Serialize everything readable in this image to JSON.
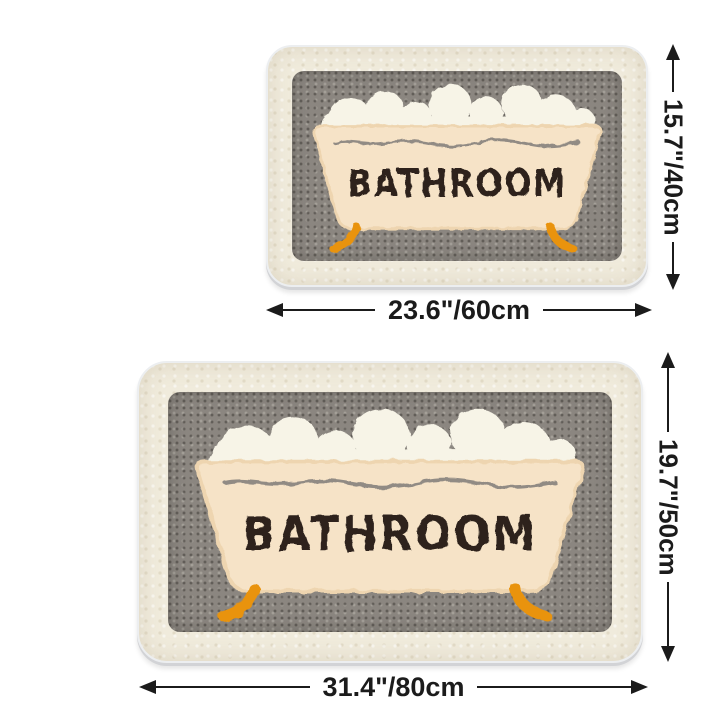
{
  "page": {
    "background_color": "#ffffff",
    "description_text": ""
  },
  "rug_design": {
    "text": "BATHROOM",
    "colors": {
      "border_fluff": "#f0ebdc",
      "inner_panel_gray": "#8b8680",
      "tub_body": "#f6e3c7",
      "tub_edge": "#eed5b0",
      "foam": "#f7f4e7",
      "lettering": "#2d241d",
      "rim_line": "#86817c",
      "feet_orange": "#e9930f",
      "backing_edge": "#d2d3d6",
      "dimension_black": "#1b1b1b"
    }
  },
  "variants": [
    {
      "name": "small",
      "width_label": "23.6\"/60cm",
      "height_label": "15.7\"/40cm"
    },
    {
      "name": "large",
      "width_label": "31.4\"/80cm",
      "height_label": "19.7\"/50cm"
    }
  ]
}
